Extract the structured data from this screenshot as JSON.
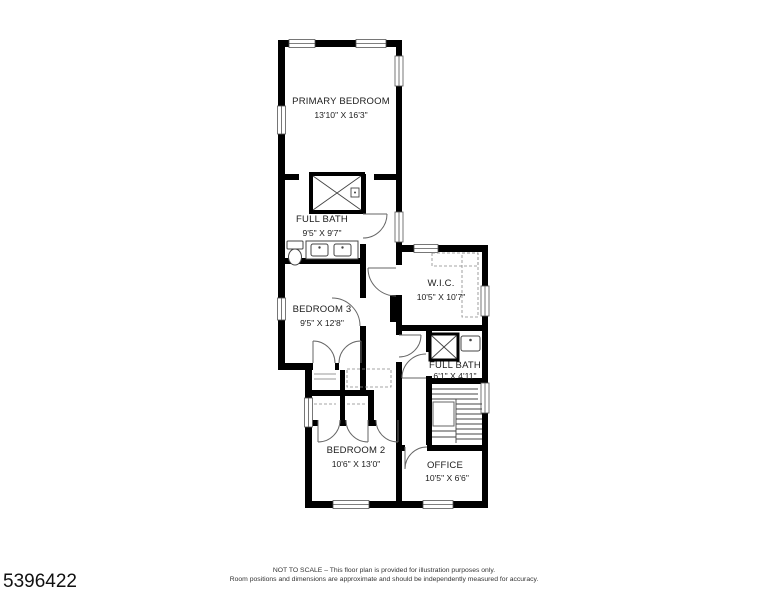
{
  "plan_id": "5396422",
  "footer": {
    "line1": "NOT TO SCALE – This floor plan is provided for illustration purposes only.",
    "line2": "Room positions and dimensions are approximate and should be independently measured for accuracy."
  },
  "rooms": [
    {
      "name": "PRIMARY BEDROOM",
      "dims": "13'10\" X 16'3\""
    },
    {
      "name": "FULL BATH",
      "dims": "9'5\" X 9'7\""
    },
    {
      "name": "BEDROOM 3",
      "dims": "9'5\" X 12'8\""
    },
    {
      "name": "W.I.C.",
      "dims": "10'5\" X 10'7\""
    },
    {
      "name": "FULL BATH",
      "dims": "6'1\" X 4'11\""
    },
    {
      "name": "BEDROOM 2",
      "dims": "10'6\" X 13'0\""
    },
    {
      "name": "OFFICE",
      "dims": "10'5\" X 6'6\""
    }
  ],
  "colors": {
    "wall": "#000000",
    "background": "#ffffff",
    "detail_line": "#555555"
  }
}
